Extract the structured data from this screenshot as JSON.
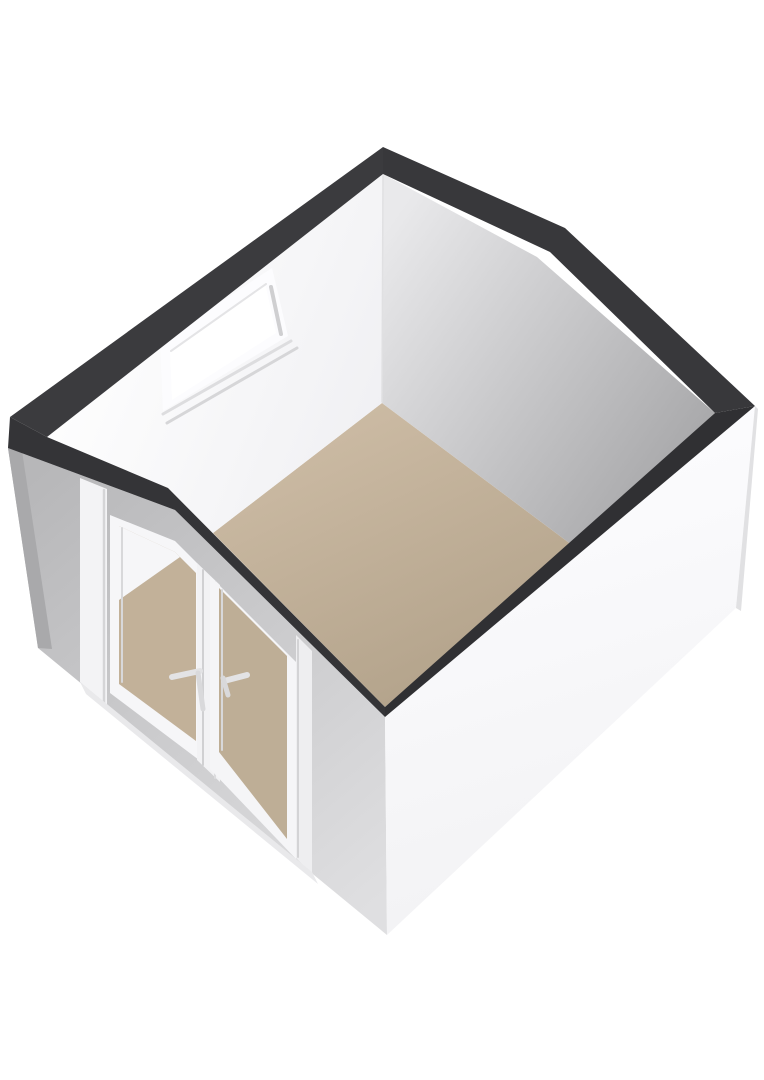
{
  "scene": {
    "title": "3d-floorplan-single-room",
    "background": "#ffffff",
    "canvas": {
      "width": 764,
      "height": 1080
    }
  },
  "palette": {
    "wall_top_band": "#353538",
    "interior_wall_white": "#fafafc",
    "interior_wall_gray": "#b0b0b2",
    "exterior_wall_white": "#f6f6f8",
    "exterior_wall_gray": "#c8c8ca",
    "floor_tan": "#bfae96",
    "frame_white": "#f4f4f6",
    "frame_shadow": "#d4d4d6",
    "background": "#ffffff"
  },
  "gradients": {
    "floor": {
      "x1": 382,
      "y1": 403,
      "x2": 520,
      "y2": 700,
      "from": "#cbbaa3",
      "to": "#b0a088"
    },
    "whiteInt": {
      "x1": 60,
      "y1": 300,
      "x2": 383,
      "y2": 430,
      "from": "#ffffff",
      "to": "#f0f0f3"
    },
    "grayInt": {
      "x1": 400,
      "y1": 210,
      "x2": 720,
      "y2": 430,
      "from": "#e9e9eb",
      "to": "#a7a7a9"
    },
    "grayExt": {
      "x1": 30,
      "y1": 480,
      "x2": 380,
      "y2": 900,
      "from": "#b7b7b9",
      "to": "#dfdfe1"
    },
    "whiteExt": {
      "x1": 450,
      "y1": 480,
      "x2": 600,
      "y2": 950,
      "from": "#fcfcfe",
      "to": "#f1f1f3"
    }
  },
  "elements": [
    {
      "name": "floor",
      "kind": "polygon",
      "fill": "gradient:floor",
      "points": [
        [
          382,
          403
        ],
        [
          572,
          545
        ],
        [
          385,
          707
        ],
        [
          213,
          533
        ]
      ]
    },
    {
      "name": "interior-wall-back-left",
      "kind": "polygon",
      "fill": "gradient:whiteInt",
      "points": [
        [
          47,
          437
        ],
        [
          383,
          174
        ],
        [
          382,
          403
        ],
        [
          213,
          533
        ],
        [
          168,
          488
        ]
      ]
    },
    {
      "name": "interior-wall-back-right",
      "kind": "polygon",
      "fill": "gradient:grayInt",
      "points": [
        [
          383,
          174
        ],
        [
          537,
          257
        ],
        [
          715,
          413
        ],
        [
          572,
          545
        ],
        [
          382,
          403
        ]
      ]
    },
    {
      "name": "interior-corner-line",
      "kind": "line",
      "stroke": "#e0e0e2",
      "width": 1.5,
      "coords": [
        383,
        176,
        382,
        402
      ]
    },
    {
      "name": "window-frame",
      "kind": "polygon",
      "fill": "#fcfcfe",
      "points": [
        [
          160,
          342
        ],
        [
          272,
          268
        ],
        [
          288,
          336
        ],
        [
          163,
          411
        ]
      ]
    },
    {
      "name": "window-sill-outer",
      "kind": "line",
      "stroke": "#dddddf",
      "width": 3,
      "coords": [
        163,
        414,
        291,
        341
      ]
    },
    {
      "name": "window-sill-inner",
      "kind": "line",
      "stroke": "#d6d6d8",
      "width": 3,
      "coords": [
        167,
        423,
        297,
        348
      ]
    },
    {
      "name": "window-glass",
      "kind": "polygon",
      "fill": "#ffffff",
      "points": [
        [
          170,
          352
        ],
        [
          265,
          283
        ],
        [
          276,
          333
        ],
        [
          172,
          400
        ]
      ]
    },
    {
      "name": "window-reveal-right",
      "kind": "line",
      "stroke": "#cfcfd1",
      "width": 4,
      "coords": [
        271,
        287,
        281,
        334
      ]
    },
    {
      "name": "window-reveal-top",
      "kind": "line",
      "stroke": "#e4e4e6",
      "width": 2,
      "coords": [
        171,
        351,
        266,
        284
      ]
    },
    {
      "name": "exterior-wall-front-left",
      "kind": "polygon",
      "fill": "gradient:grayExt",
      "points": [
        [
          8,
          448
        ],
        [
          175,
          510
        ],
        [
          385,
          717
        ],
        [
          387,
          935
        ],
        [
          38,
          648
        ]
      ]
    },
    {
      "name": "exterior-left-edge-sliver",
      "kind": "polygon",
      "fill": "#a9a9ab",
      "points": [
        [
          8,
          448
        ],
        [
          22,
          451
        ],
        [
          52,
          649
        ],
        [
          38,
          648
        ]
      ]
    },
    {
      "name": "door-frame-left-post",
      "kind": "polygon",
      "fill": "#f3f3f5",
      "points": [
        [
          80,
          478
        ],
        [
          107,
          489
        ],
        [
          107,
          705
        ],
        [
          80,
          682
        ]
      ]
    },
    {
      "name": "door-frame-left-post-shade",
      "kind": "line",
      "stroke": "#d5d5d7",
      "width": 2.5,
      "coords": [
        104,
        490,
        104,
        703
      ]
    },
    {
      "name": "door-left-panel",
      "kind": "polygon",
      "fill": "#f6f6f8",
      "points": [
        [
          110,
          515
        ],
        [
          175,
          541
        ],
        [
          207,
          573
        ],
        [
          207,
          766
        ],
        [
          110,
          693
        ]
      ]
    },
    {
      "name": "door-left-glass",
      "kind": "polygon",
      "fill": "#c2b199",
      "points": [
        [
          119,
          526
        ],
        [
          175,
          552
        ],
        [
          196,
          573
        ],
        [
          196,
          741
        ],
        [
          119,
          684
        ]
      ]
    },
    {
      "name": "door-left-glass-interior-view",
      "kind": "polygon",
      "fill": "#f6f6f8",
      "points": [
        [
          119,
          526
        ],
        [
          175,
          552
        ],
        [
          180,
          557
        ],
        [
          119,
          600
        ]
      ]
    },
    {
      "name": "door-left-glass-shade",
      "kind": "line",
      "stroke": "#d8d8da",
      "width": 2,
      "coords": [
        122,
        528,
        122,
        682
      ]
    },
    {
      "name": "door-center-mullion",
      "kind": "polygon",
      "fill": "#f2f2f4",
      "points": [
        [
          197,
          563
        ],
        [
          220,
          585
        ],
        [
          220,
          782
        ],
        [
          197,
          760
        ]
      ]
    },
    {
      "name": "door-center-mullion-shade-left",
      "kind": "line",
      "stroke": "#d0d0d2",
      "width": 2,
      "coords": [
        203,
        570,
        203,
        765
      ]
    },
    {
      "name": "door-center-mullion-shade-right",
      "kind": "line",
      "stroke": "#dcdcde",
      "width": 2,
      "coords": [
        215,
        582,
        215,
        778
      ]
    },
    {
      "name": "door-right-panel",
      "kind": "polygon",
      "fill": "#f5f5f7",
      "points": [
        [
          210,
          576
        ],
        [
          296,
          662
        ],
        [
          296,
          859
        ],
        [
          210,
          769
        ]
      ]
    },
    {
      "name": "door-right-glass",
      "kind": "polygon",
      "fill": "#beae96",
      "points": [
        [
          219,
          588
        ],
        [
          287,
          656
        ],
        [
          287,
          839
        ],
        [
          219,
          752
        ]
      ]
    },
    {
      "name": "door-right-glass-shade",
      "kind": "line",
      "stroke": "#d8d8da",
      "width": 2,
      "coords": [
        222,
        590,
        222,
        750
      ]
    },
    {
      "name": "door-frame-right-post",
      "kind": "polygon",
      "fill": "#eeeef0",
      "points": [
        [
          296,
          635
        ],
        [
          312,
          651
        ],
        [
          312,
          874
        ],
        [
          296,
          858
        ]
      ]
    },
    {
      "name": "door-frame-right-post-shade",
      "kind": "line",
      "stroke": "#d3d3d5",
      "width": 2,
      "coords": [
        298,
        640,
        298,
        857
      ]
    },
    {
      "name": "door-threshold",
      "kind": "polygon",
      "fill": "#e9e9eb",
      "points": [
        [
          80,
          682
        ],
        [
          312,
          872
        ],
        [
          318,
          884
        ],
        [
          86,
          694
        ]
      ]
    },
    {
      "name": "door-handle-left-bar",
      "kind": "line",
      "stroke": "#e3e3e5",
      "width": 6,
      "coords": [
        172,
        677,
        200,
        671
      ]
    },
    {
      "name": "door-handle-left-hook",
      "kind": "line",
      "stroke": "#d9d9db",
      "width": 5,
      "coords": [
        198,
        673,
        203,
        709
      ]
    },
    {
      "name": "door-handle-right-bar",
      "kind": "line",
      "stroke": "#e3e3e5",
      "width": 6,
      "coords": [
        224,
        681,
        247,
        675
      ]
    },
    {
      "name": "door-handle-right-hook",
      "kind": "line",
      "stroke": "#d9d9db",
      "width": 5,
      "coords": [
        223,
        678,
        228,
        695
      ]
    },
    {
      "name": "exterior-wall-front-right",
      "kind": "polygon",
      "fill": "gradient:whiteExt",
      "points": [
        [
          385,
          717
        ],
        [
          755,
          406
        ],
        [
          736,
          608
        ],
        [
          387,
          935
        ]
      ]
    },
    {
      "name": "exterior-right-corner-strip",
      "kind": "polygon",
      "fill": "#e1e1e3",
      "points": [
        [
          755,
          406
        ],
        [
          758,
          409
        ],
        [
          741,
          611
        ],
        [
          736,
          608
        ]
      ]
    },
    {
      "name": "wall-top-band-back-left",
      "kind": "polygon",
      "fill": "#3b3b3e",
      "points": [
        [
          10,
          417
        ],
        [
          383,
          147
        ],
        [
          383,
          174
        ],
        [
          47,
          437
        ]
      ]
    },
    {
      "name": "wall-top-band-back-right",
      "kind": "polygon",
      "fill": "#38383b",
      "points": [
        [
          383,
          147
        ],
        [
          565,
          228
        ],
        [
          755,
          406
        ],
        [
          715,
          413
        ],
        [
          550,
          252
        ],
        [
          383,
          174
        ]
      ]
    },
    {
      "name": "wall-top-band-front-right",
      "kind": "polygon",
      "fill": "#303033",
      "points": [
        [
          385,
          707
        ],
        [
          715,
          413
        ],
        [
          755,
          406
        ],
        [
          385,
          717
        ]
      ]
    },
    {
      "name": "wall-top-band-front-left",
      "kind": "polygon",
      "fill": "#343437",
      "points": [
        [
          10,
          417
        ],
        [
          47,
          437
        ],
        [
          168,
          488
        ],
        [
          385,
          707
        ],
        [
          385,
          717
        ],
        [
          175,
          510
        ],
        [
          8,
          448
        ]
      ]
    }
  ]
}
